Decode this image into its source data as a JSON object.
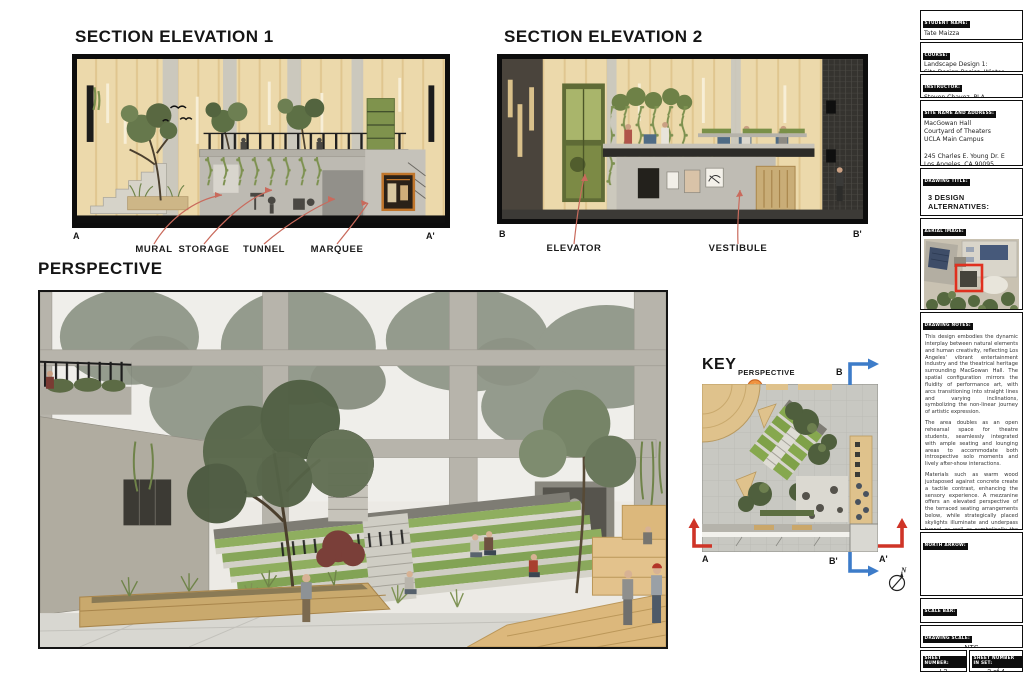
{
  "colors": {
    "accent_leader_red": "#c96a5c",
    "section_cut_red": "#cf3427",
    "section_cut_blue": "#3d7cc9",
    "perspective_pin_orange": "#ef9440",
    "aerial_highlight_red": "#e0301f",
    "wood_tan": "#ecd9ab",
    "turf_green": "#86a84e"
  },
  "sections": {
    "elevation1": {
      "title": "SECTION ELEVATION 1",
      "marker_left": "A",
      "marker_right": "A'",
      "callouts": [
        "MURAL",
        "STORAGE",
        "TUNNEL",
        "MARQUEE"
      ]
    },
    "elevation2": {
      "title": "SECTION ELEVATION 2",
      "marker_left": "B",
      "marker_right": "B'",
      "callouts": [
        "ELEVATOR",
        "VESTIBULE"
      ]
    },
    "perspective": {
      "title": "PERSPECTIVE"
    },
    "key": {
      "title": "KEY",
      "perspective_label": "PERSPECTIVE",
      "marker_a": "A",
      "marker_a_prime": "A'",
      "marker_b": "B",
      "marker_b_prime": "B'",
      "north_letter": "N"
    }
  },
  "titleblock": {
    "student": {
      "label": "STUDENT NAME:",
      "value": "Tate Maizza"
    },
    "course": {
      "label": "COURSE:",
      "line1": "Landscape Design 1:",
      "line2": "Site Design Basics, Winter 2025"
    },
    "instructor": {
      "label": "INSTRUCTOR:",
      "value": "Steven Chavez, PLA"
    },
    "site": {
      "label": "SITE NAME AND ADDRESS:",
      "line1": "MacGowan Hall",
      "line2": "Courtyard of Theaters",
      "line3": "UCLA Main Campus",
      "line4": "245 Charles E. Young Dr. E",
      "line5": "Los Angeles, CA 90095"
    },
    "drawing_title": {
      "label": "DRAWING TITLE:",
      "line1": "3 DESIGN ALTERNATIVES:",
      "line2": "MACGOWAN HALL, UCLA"
    },
    "aerial": {
      "label": "AERIAL IMAGE:"
    },
    "notes": {
      "label": "DRAWING NOTES:",
      "p1": "This design embodies the dynamic interplay between natural elements and human creativity, reflecting Los Angeles' vibrant entertainment industry and the theatrical heritage surrounding MacGowan Hall. The spatial configuration mirrors the fluidity of performance art, with arcs transitioning into straight lines and varying inclinations, symbolizing the non-linear journey of artistic expression.",
      "p2": "The area doubles as an open rehearsal space for theatre students, seamlessly integrated with ample seating and lounging areas to accommodate both introspective solo moments and lively after-show interactions.",
      "p3": "Materials such as warm wood juxtaposed against concrete create a tactile contrast, enhancing the sensory experience. A mezzanine offers an elevated perspective of the terraced seating arrangements below, while strategically placed skylights illuminate and underpass tunnel as well as symbolically the evolving 'human stage,' capturing the essence of daily transformations."
    },
    "north_arrow": {
      "label": "NORTH ARROW:"
    },
    "scale_bar": {
      "label": "SCALE BAR:"
    },
    "drawing_scale": {
      "label": "DRAWING SCALE:",
      "value": "NTS"
    },
    "sheet_number": {
      "label": "SHEET NUMBER:",
      "value": "L3"
    },
    "sheet_number_in_set": {
      "label": "SHEET NUMBER IN SET:",
      "value": "3 of 4"
    }
  }
}
